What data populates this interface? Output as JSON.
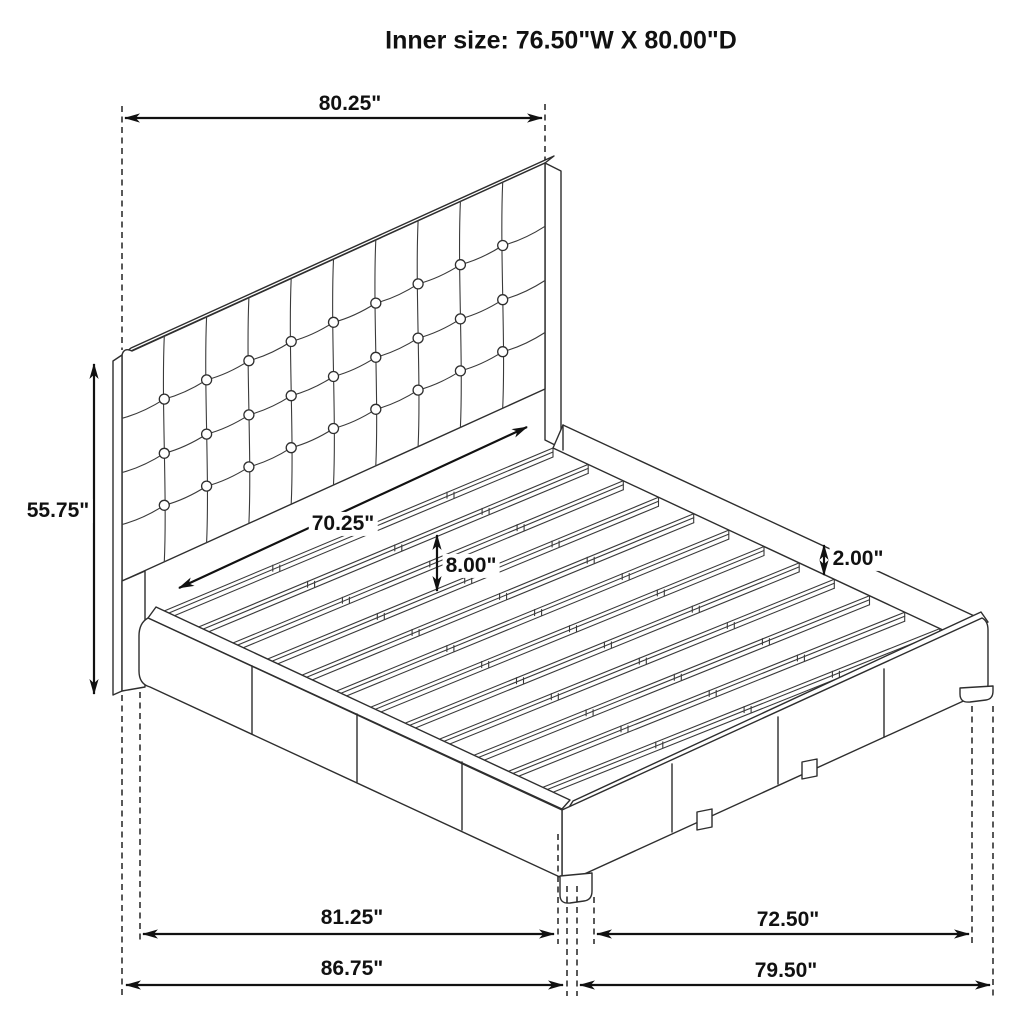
{
  "title": "Inner size: 76.50\"W X 80.00\"D",
  "dimensions": {
    "headboard_width": "80.25\"",
    "headboard_height": "55.75\"",
    "slat_span_width": "70.25\"",
    "platform_height": "8.00\"",
    "slat_lip_height": "2.00\"",
    "base_width_inner": "81.25\"",
    "base_depth_inner": "72.50\"",
    "overall_width": "86.75\"",
    "overall_depth": "79.50\""
  }
}
